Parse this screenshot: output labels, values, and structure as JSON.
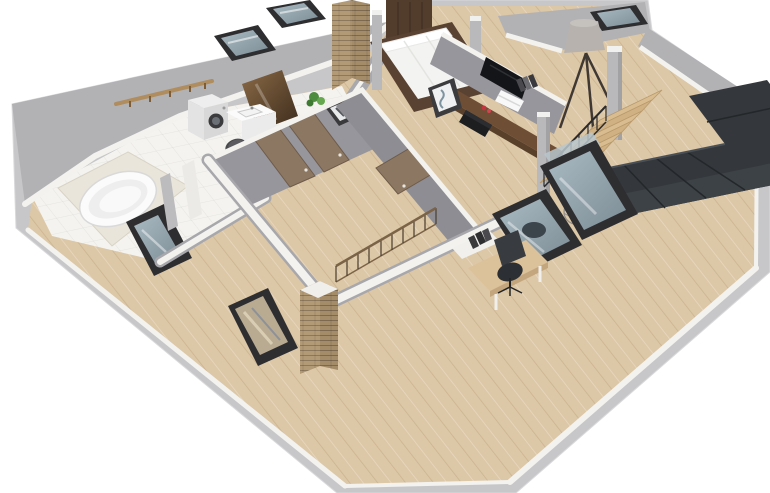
{
  "scene": {
    "type": "3d-floor-plan-render",
    "description": "Isometric 3D render of an attic apartment floor plan on a white background",
    "rooms": [
      "bathroom",
      "hallway-landing",
      "central-stair-room",
      "bedroom",
      "living-room",
      "office-nook"
    ],
    "objects": [
      "roof-skylights",
      "washing-machine",
      "bathroom-sink",
      "bathtub",
      "towel-rail",
      "bronze-splash-panel",
      "bed",
      "wardrobe",
      "brick-chimney",
      "wood-doors",
      "picture-frames",
      "stair-railing",
      "wall-tv",
      "media-shelf",
      "tripod-floor-lamp",
      "wire-sphere-lamp",
      "support-columns",
      "sectional-sofa",
      "wooden-staircase",
      "desk",
      "office-chair",
      "potted-plant"
    ]
  },
  "colors": {
    "background": "#ffffff",
    "roof_band": "#c7c7c9",
    "roof_slope": "#b2b2b5",
    "wall_top_white": "#f3f2ef",
    "wall_gray": "#97969c",
    "wall_gray_dark": "#8e8d93",
    "wall_low_gray": "#a8a7ab",
    "wood_floor": "#dcc7a6",
    "tile_floor": "#f4f3ef",
    "tub_platform": "#e9e5da",
    "white_fixture": "#fbfbfb",
    "appliance_white": "#eeeeee",
    "skylight_frame": "#2e2e30",
    "skylight_glass": "#93a5ae",
    "glass_reflection": "#b9ab92",
    "brick": "#b39a76",
    "brick_shade": "#a58c69",
    "door_wood": "#8c7862",
    "walnut_shelf": "#6e4e35",
    "walnut_edge": "#59402b",
    "bed_frame": "#5a4232",
    "mattress": "#f3f3f1",
    "wardrobe": "#523c2b",
    "tv_black": "#141518",
    "sofa": "#34383c",
    "sofa_cushion": "#3d4247",
    "sofa_seam": "#23272a",
    "stair_wood": "#d9bd91",
    "stair_wood_alt": "#d0b184",
    "railing_metal": "#2b2b2d",
    "railing_wood": "#7a6347",
    "lamp_shade": "#b7b2ae",
    "lamp_legs": "#3f3833",
    "column_gray": "#b9b9bc",
    "desk_wood": "#dcc29a",
    "chair_black": "#2c2f33",
    "plant_green": "#4e8c3e",
    "bronze_light": "#8a6a46",
    "bronze_dark": "#3c2b1c",
    "accent_red": "#c2333f"
  }
}
